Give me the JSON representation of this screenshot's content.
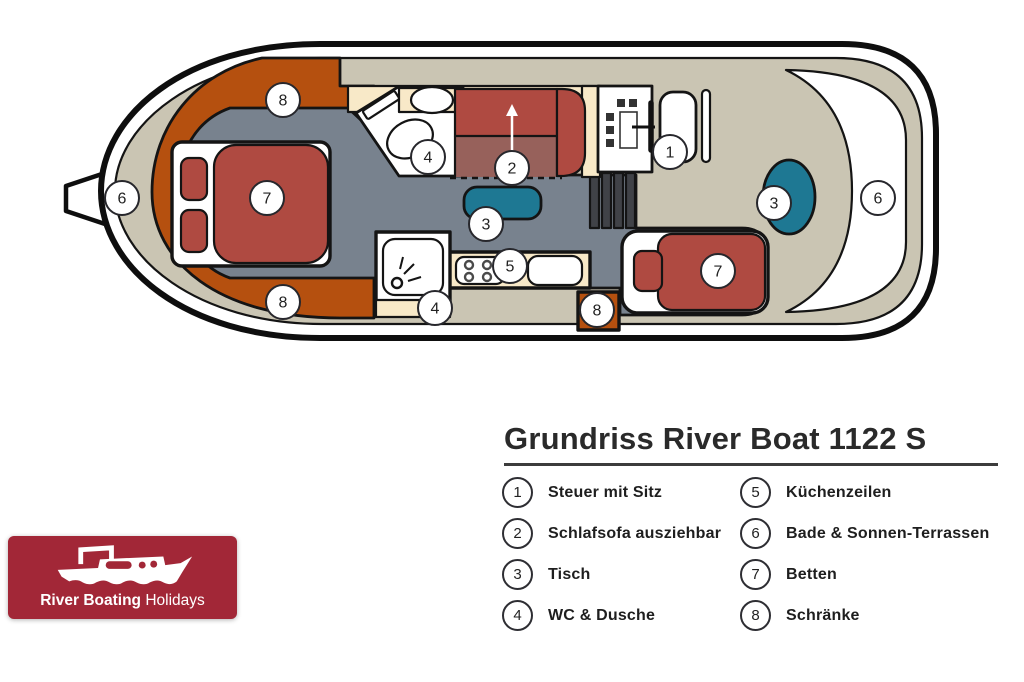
{
  "title": "Grundriss River Boat 1122 S",
  "legend": {
    "column1": [
      {
        "num": "1",
        "label": "Steuer mit Sitz"
      },
      {
        "num": "2",
        "label": "Schlafsofa ausziehbar"
      },
      {
        "num": "3",
        "label": "Tisch"
      },
      {
        "num": "4",
        "label": "WC & Dusche"
      }
    ],
    "column2": [
      {
        "num": "5",
        "label": "Küchenzeilen"
      },
      {
        "num": "6",
        "label": "Bade & Sonnen-Terrassen"
      },
      {
        "num": "7",
        "label": "Betten"
      },
      {
        "num": "8",
        "label": "Schränke"
      }
    ]
  },
  "plan": {
    "markers": [
      {
        "n": "6",
        "area": "bow-terrace"
      },
      {
        "n": "8",
        "area": "front-wardrobe-top"
      },
      {
        "n": "7",
        "area": "front-bed"
      },
      {
        "n": "8",
        "area": "front-wardrobe-bottom"
      },
      {
        "n": "4",
        "area": "wc"
      },
      {
        "n": "2",
        "area": "sofa-bed"
      },
      {
        "n": "3",
        "area": "saloon-table"
      },
      {
        "n": "5",
        "area": "kitchen"
      },
      {
        "n": "4",
        "area": "shower"
      },
      {
        "n": "8",
        "area": "kitchen-cupboard"
      },
      {
        "n": "1",
        "area": "helm-seat"
      },
      {
        "n": "7",
        "area": "rear-bed"
      },
      {
        "n": "3",
        "area": "rear-table"
      },
      {
        "n": "6",
        "area": "stern-terrace"
      }
    ],
    "colors": {
      "deck_tan": "#CAC5B3",
      "floor_slate": "#78828E",
      "cabinet_orange": "#B5500F",
      "furniture_red": "#AF4A41",
      "sofa_pullout_red": "#97615B",
      "walkway_cream": "#F8E9C8",
      "table_teal": "#1E7893",
      "stair_dark": "#404247",
      "outline_black": "#141414",
      "logo_red": "#A22737"
    }
  },
  "logo": {
    "brand_bold": "River Boating",
    "brand_regular": "Holidays"
  }
}
